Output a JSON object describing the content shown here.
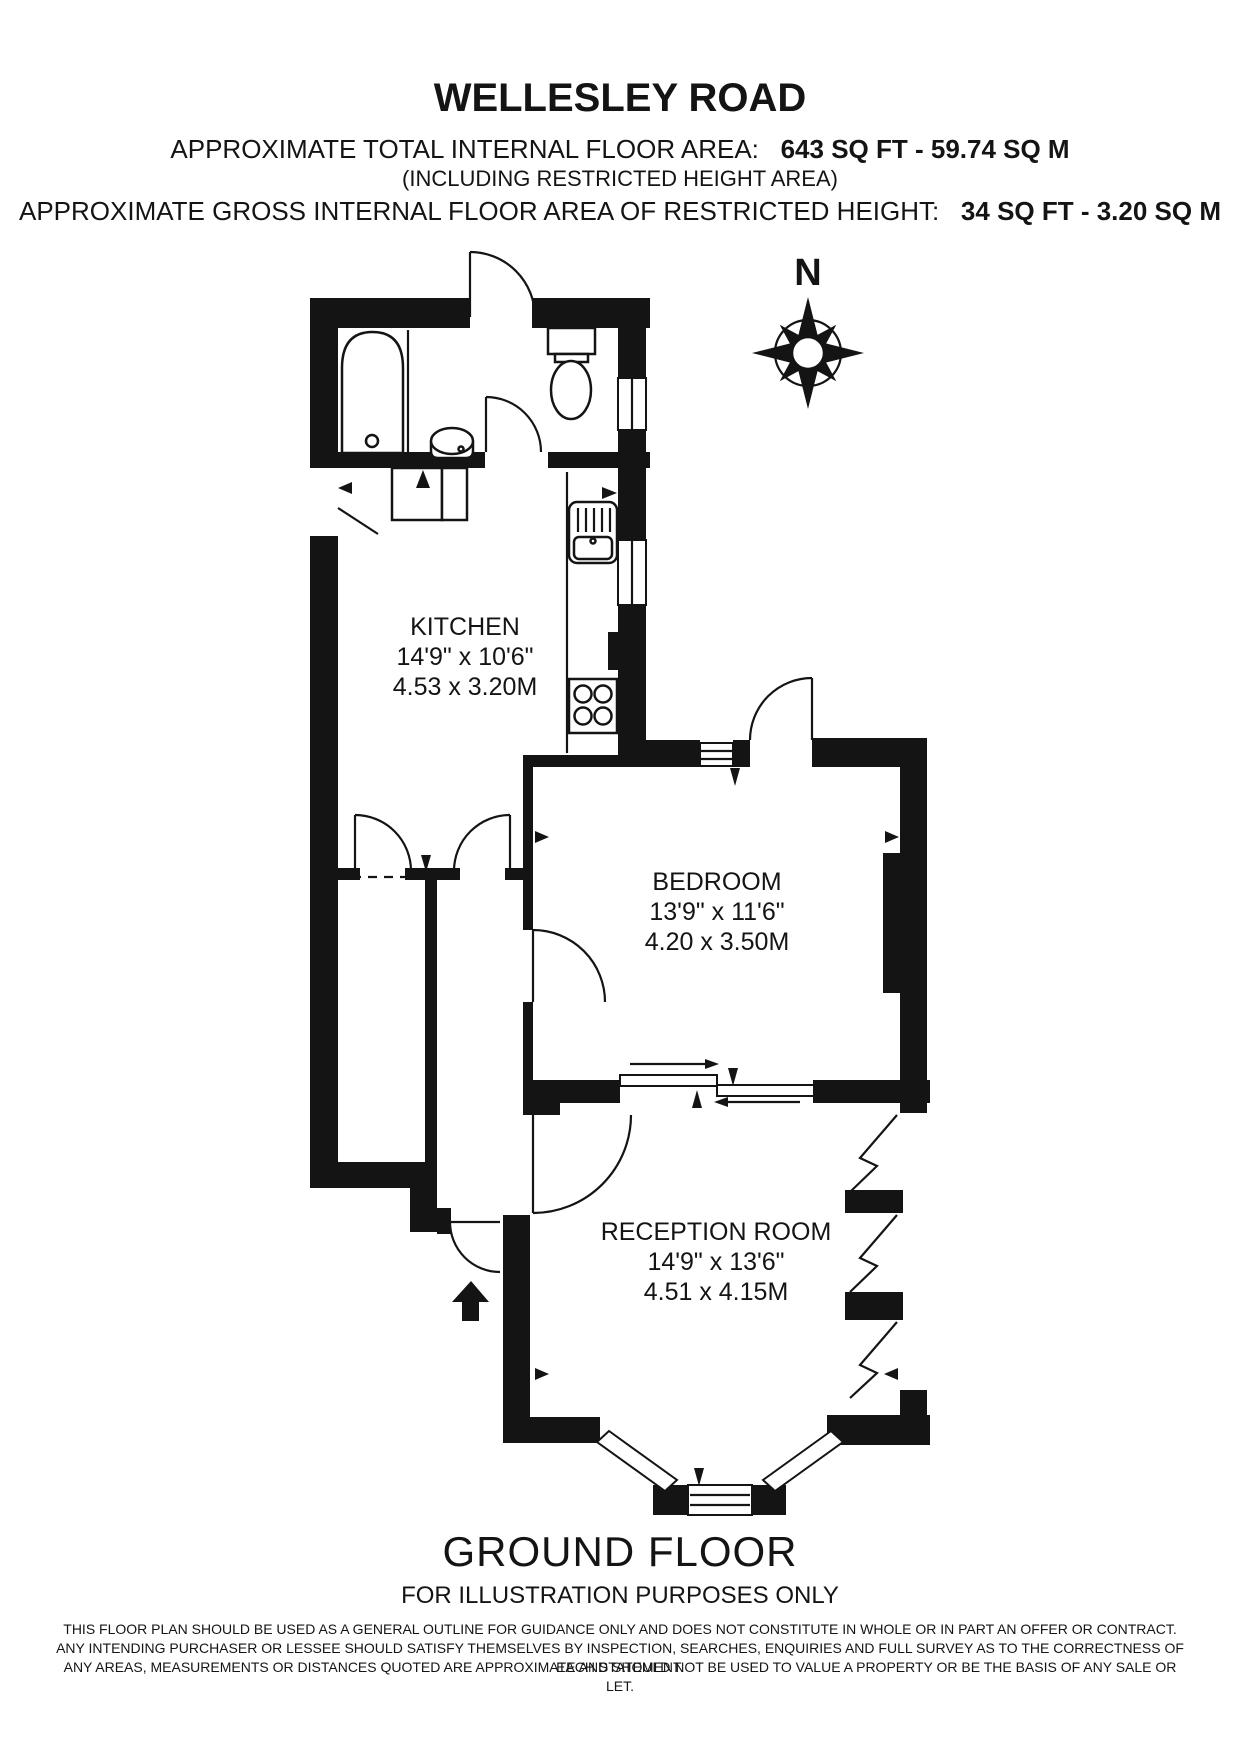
{
  "header": {
    "title": "WELLESLEY ROAD",
    "area_line": {
      "label": "APPROXIMATE TOTAL INTERNAL FLOOR AREA:",
      "value": "643 SQ FT - 59.74 SQ M"
    },
    "area_note": "(INCLUDING RESTRICTED HEIGHT AREA)",
    "restricted_line": {
      "label": "APPROXIMATE GROSS INTERNAL FLOOR AREA OF RESTRICTED HEIGHT:",
      "value": "34 SQ FT - 3.20 SQ M"
    }
  },
  "compass": {
    "north_label": "N"
  },
  "rooms": {
    "kitchen": {
      "name": "KITCHEN",
      "dimensions_imperial": "14'9\" x 10'6\"",
      "dimensions_metric": "4.53 x 3.20M"
    },
    "bedroom": {
      "name": "BEDROOM",
      "dimensions_imperial": "13'9\" x 11'6\"",
      "dimensions_metric": "4.20 x 3.50M"
    },
    "reception": {
      "name": "RECEPTION ROOM",
      "dimensions_imperial": "14'9\" x 13'6\"",
      "dimensions_metric": "4.51 x 4.15M"
    }
  },
  "footer": {
    "floor_label": "GROUND FLOOR",
    "subtitle": "FOR ILLUSTRATION PURPOSES ONLY",
    "disclaimer_lines": [
      "THIS FLOOR PLAN SHOULD BE USED AS A GENERAL OUTLINE FOR GUIDANCE ONLY AND DOES NOT CONSTITUTE IN WHOLE OR IN PART AN OFFER OR CONTRACT.",
      "ANY INTENDING PURCHASER OR LESSEE SHOULD SATISFY THEMSELVES BY INSPECTION, SEARCHES, ENQUIRIES AND FULL SURVEY AS TO THE CORRECTNESS OF EACH STATEMENT.",
      "ANY AREAS, MEASUREMENTS OR DISTANCES QUOTED ARE APPROXIMATE AND SHOULD NOT BE USED TO VALUE A PROPERTY OR BE THE BASIS OF ANY SALE OR LET."
    ]
  },
  "colors": {
    "wall": "#141414",
    "background": "#ffffff"
  }
}
